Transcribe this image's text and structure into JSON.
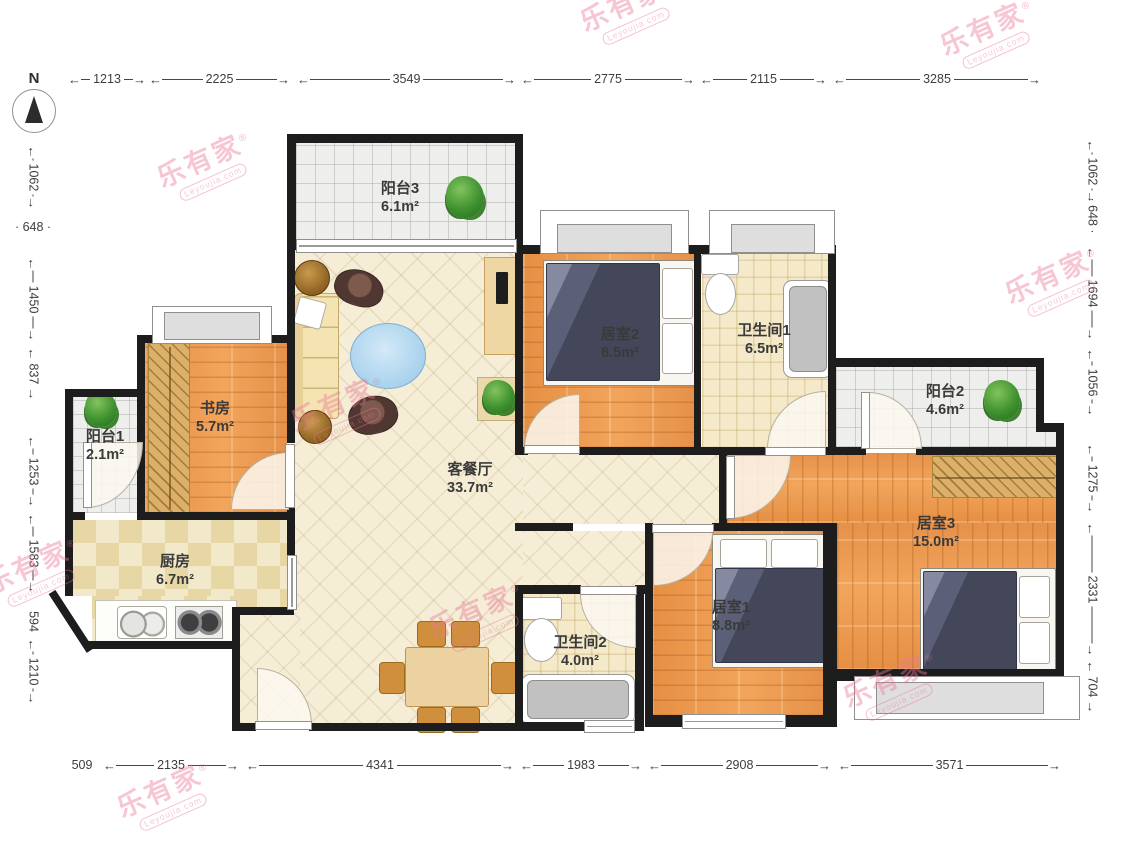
{
  "compass": {
    "label": "N"
  },
  "watermark": {
    "brand": "乐有家",
    "reg": "®",
    "domain": "Leyoujia.com"
  },
  "dims": {
    "top": [
      "1213",
      "2225",
      "3549",
      "2775",
      "2115",
      "3285"
    ],
    "bottom": [
      "509",
      "2135",
      "4341",
      "1983",
      "2908",
      "3571"
    ],
    "left": [
      "1062",
      "648",
      "1450",
      "837",
      "1253",
      "1583",
      "594",
      "1210"
    ],
    "right": [
      "1062",
      "648",
      "1694",
      "1056",
      "1275",
      "2331",
      "704"
    ]
  },
  "rooms": [
    {
      "name": "阳台3",
      "area": "6.1m²"
    },
    {
      "name": "居室2",
      "area": "8.5m²"
    },
    {
      "name": "卫生间1",
      "area": "6.5m²"
    },
    {
      "name": "阳台2",
      "area": "4.6m²"
    },
    {
      "name": "书房",
      "area": "5.7m²"
    },
    {
      "name": "阳台1",
      "area": "2.1m²"
    },
    {
      "name": "厨房",
      "area": "6.7m²"
    },
    {
      "name": "客餐厅",
      "area": "33.7m²"
    },
    {
      "name": "卫生间2",
      "area": "4.0m²"
    },
    {
      "name": "居室1",
      "area": "8.8m²"
    },
    {
      "name": "居室3",
      "area": "15.0m²"
    }
  ],
  "colors": {
    "wall": "#1d1d1d",
    "wood_floor": "#eb9b52",
    "living_floor": "#f5edd6",
    "tile_floor": "#f4e9c9",
    "balcony_floor": "#eeeeec",
    "bed_blanket": "#5b6078",
    "watermark_pink": "#e97695"
  }
}
